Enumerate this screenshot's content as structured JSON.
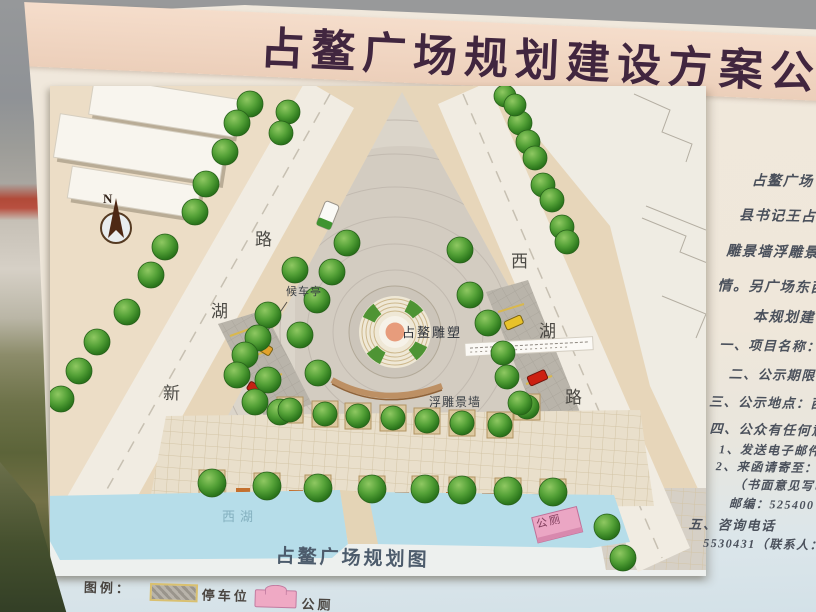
{
  "board": {
    "title": "占鳌广场规划建设方案公",
    "plan_caption": "占鳌广场规划图",
    "legend": {
      "label": "图例：",
      "parking_label": "停车位",
      "toilet_label": "公厕"
    },
    "right_panel": {
      "lines": [
        {
          "text": "占鳌广场",
          "x": 752,
          "y": 170,
          "size": 14
        },
        {
          "text": "县书记王占鳌",
          "x": 740,
          "y": 205,
          "size": 14
        },
        {
          "text": "雕景墙浮雕景墙",
          "x": 728,
          "y": 241,
          "size": 14
        },
        {
          "text": "情。另广场东西",
          "x": 720,
          "y": 276,
          "size": 14
        },
        {
          "text": "本规划建设",
          "x": 756,
          "y": 306,
          "size": 14
        },
        {
          "text": "一、项目名称：占",
          "x": 723,
          "y": 335,
          "size": 13
        },
        {
          "text": "二、公示期限：201",
          "x": 733,
          "y": 364,
          "size": 13
        },
        {
          "text": "三、公示地点：西湖",
          "x": 714,
          "y": 392,
          "size": 13
        },
        {
          "text": "四、公众有任何意见请",
          "x": 715,
          "y": 419,
          "size": 13
        },
        {
          "text": "1、发送电子邮件至",
          "x": 725,
          "y": 441,
          "size": 12
        },
        {
          "text": "2、来函请寄至：电",
          "x": 722,
          "y": 458,
          "size": 12
        },
        {
          "text": "（书面意见写明",
          "x": 740,
          "y": 476,
          "size": 12
        },
        {
          "text": "邮编：525400",
          "x": 736,
          "y": 495,
          "size": 12
        },
        {
          "text": "五、咨询电话",
          "x": 696,
          "y": 515,
          "size": 13
        },
        {
          "text": "5530431（联系人：陈工",
          "x": 711,
          "y": 535,
          "size": 12
        }
      ]
    }
  },
  "map": {
    "compass": "N",
    "road_left": {
      "name": "新湖路",
      "chars": [
        "新",
        "湖",
        "路"
      ]
    },
    "road_right": {
      "name": "西湖路",
      "chars": [
        "西",
        "湖",
        "路"
      ]
    },
    "labels": {
      "bus_shelter": "候车亭",
      "sculpture": "占鳌雕塑",
      "relief_wall": "浮雕景墙",
      "lake": "西湖",
      "toilet": "公厕"
    },
    "colors": {
      "water": "#b6dde9",
      "tree": "#4f9a34",
      "toilet_pink": "#eba6c4",
      "band_pink": "#f2d8c6",
      "title_text": "#41263f"
    }
  }
}
